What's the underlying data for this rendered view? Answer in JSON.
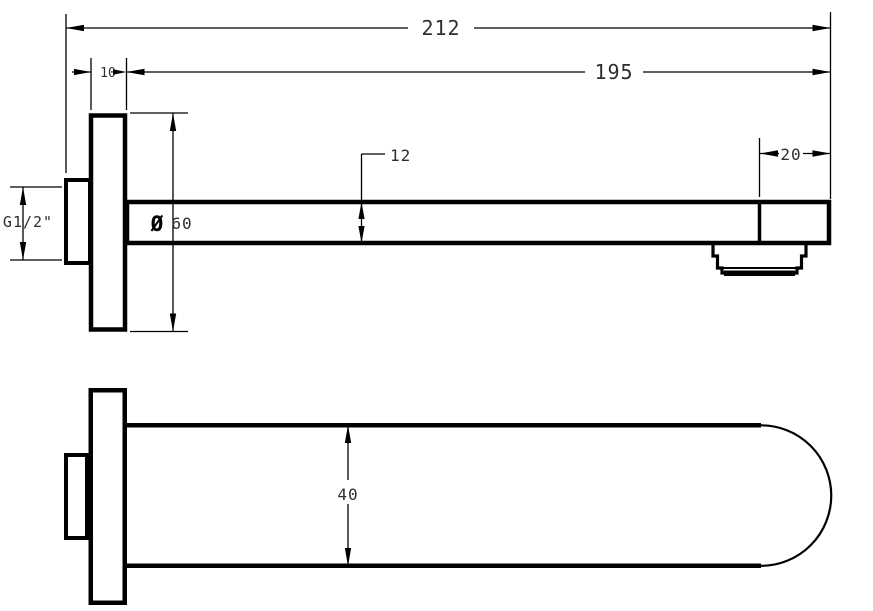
{
  "meta": {
    "drawing_type": "technical dimension drawing",
    "subject": "wall-mounted bath spout, side view and plan view",
    "units": "mm",
    "background_color": "#ffffff",
    "line_color": "#000000",
    "text_color": "#2e2e2e"
  },
  "dims": {
    "total_length": "212",
    "projection_length": "195",
    "flange_thickness": "10",
    "spout_section_height": "12",
    "end_section_length": "20",
    "flange_diameter_symbol": "Ø",
    "flange_diameter_value": "60",
    "inlet_thread": "G1/2\"",
    "spout_width": "40"
  }
}
